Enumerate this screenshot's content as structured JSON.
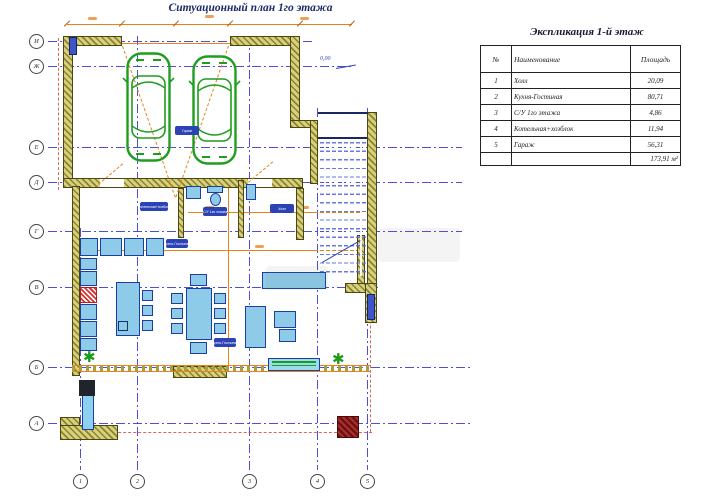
{
  "page": {
    "title": "Ситуационный план 1го этажа"
  },
  "explication": {
    "title": "Экспликация 1-й этаж",
    "columns": {
      "num": "№",
      "name": "Наименование",
      "area": "Площадь"
    },
    "rows": [
      {
        "num": "1",
        "name": "Холл",
        "area": "20,09"
      },
      {
        "num": "2",
        "name": "Кухня-Гостиная",
        "area": "80,71"
      },
      {
        "num": "3",
        "name": "С/У 1го этажа",
        "area": "4,86"
      },
      {
        "num": "4",
        "name": "Котельная+хозблок",
        "area": "11,94"
      },
      {
        "num": "5",
        "name": "Гараж",
        "area": "56,31"
      }
    ],
    "total_area": "173,91 м²"
  },
  "axes": {
    "horizontal": [
      "И",
      "Ж",
      "Е",
      "Д",
      "Г",
      "В",
      "Б",
      "А"
    ],
    "vertical": [
      "1",
      "2",
      "3",
      "4",
      "5"
    ]
  },
  "room_labels": {
    "garage": "Гараж",
    "boiler": "Котельная+хозблок",
    "wc": "С/У 1го этажа",
    "hall": "Холл",
    "kitchen": "Кухня-Гостиная",
    "living": "Кухня-Гостиная"
  },
  "annotations": {
    "elevation_mark": "0,00"
  },
  "icons": {
    "plant": "✱"
  },
  "colors": {
    "grid_line": "#3b3bd1",
    "wall_fill": "#d8d07c",
    "wall_hatch": "#8a8430",
    "dimension": "#e8821e",
    "furniture_fill": "#8ecbe8",
    "furniture_stroke": "#1c3f9e",
    "label_pill": "#2b43b5",
    "car_outline": "#1e9e1e",
    "red_boundary": "#cf4f3f"
  }
}
